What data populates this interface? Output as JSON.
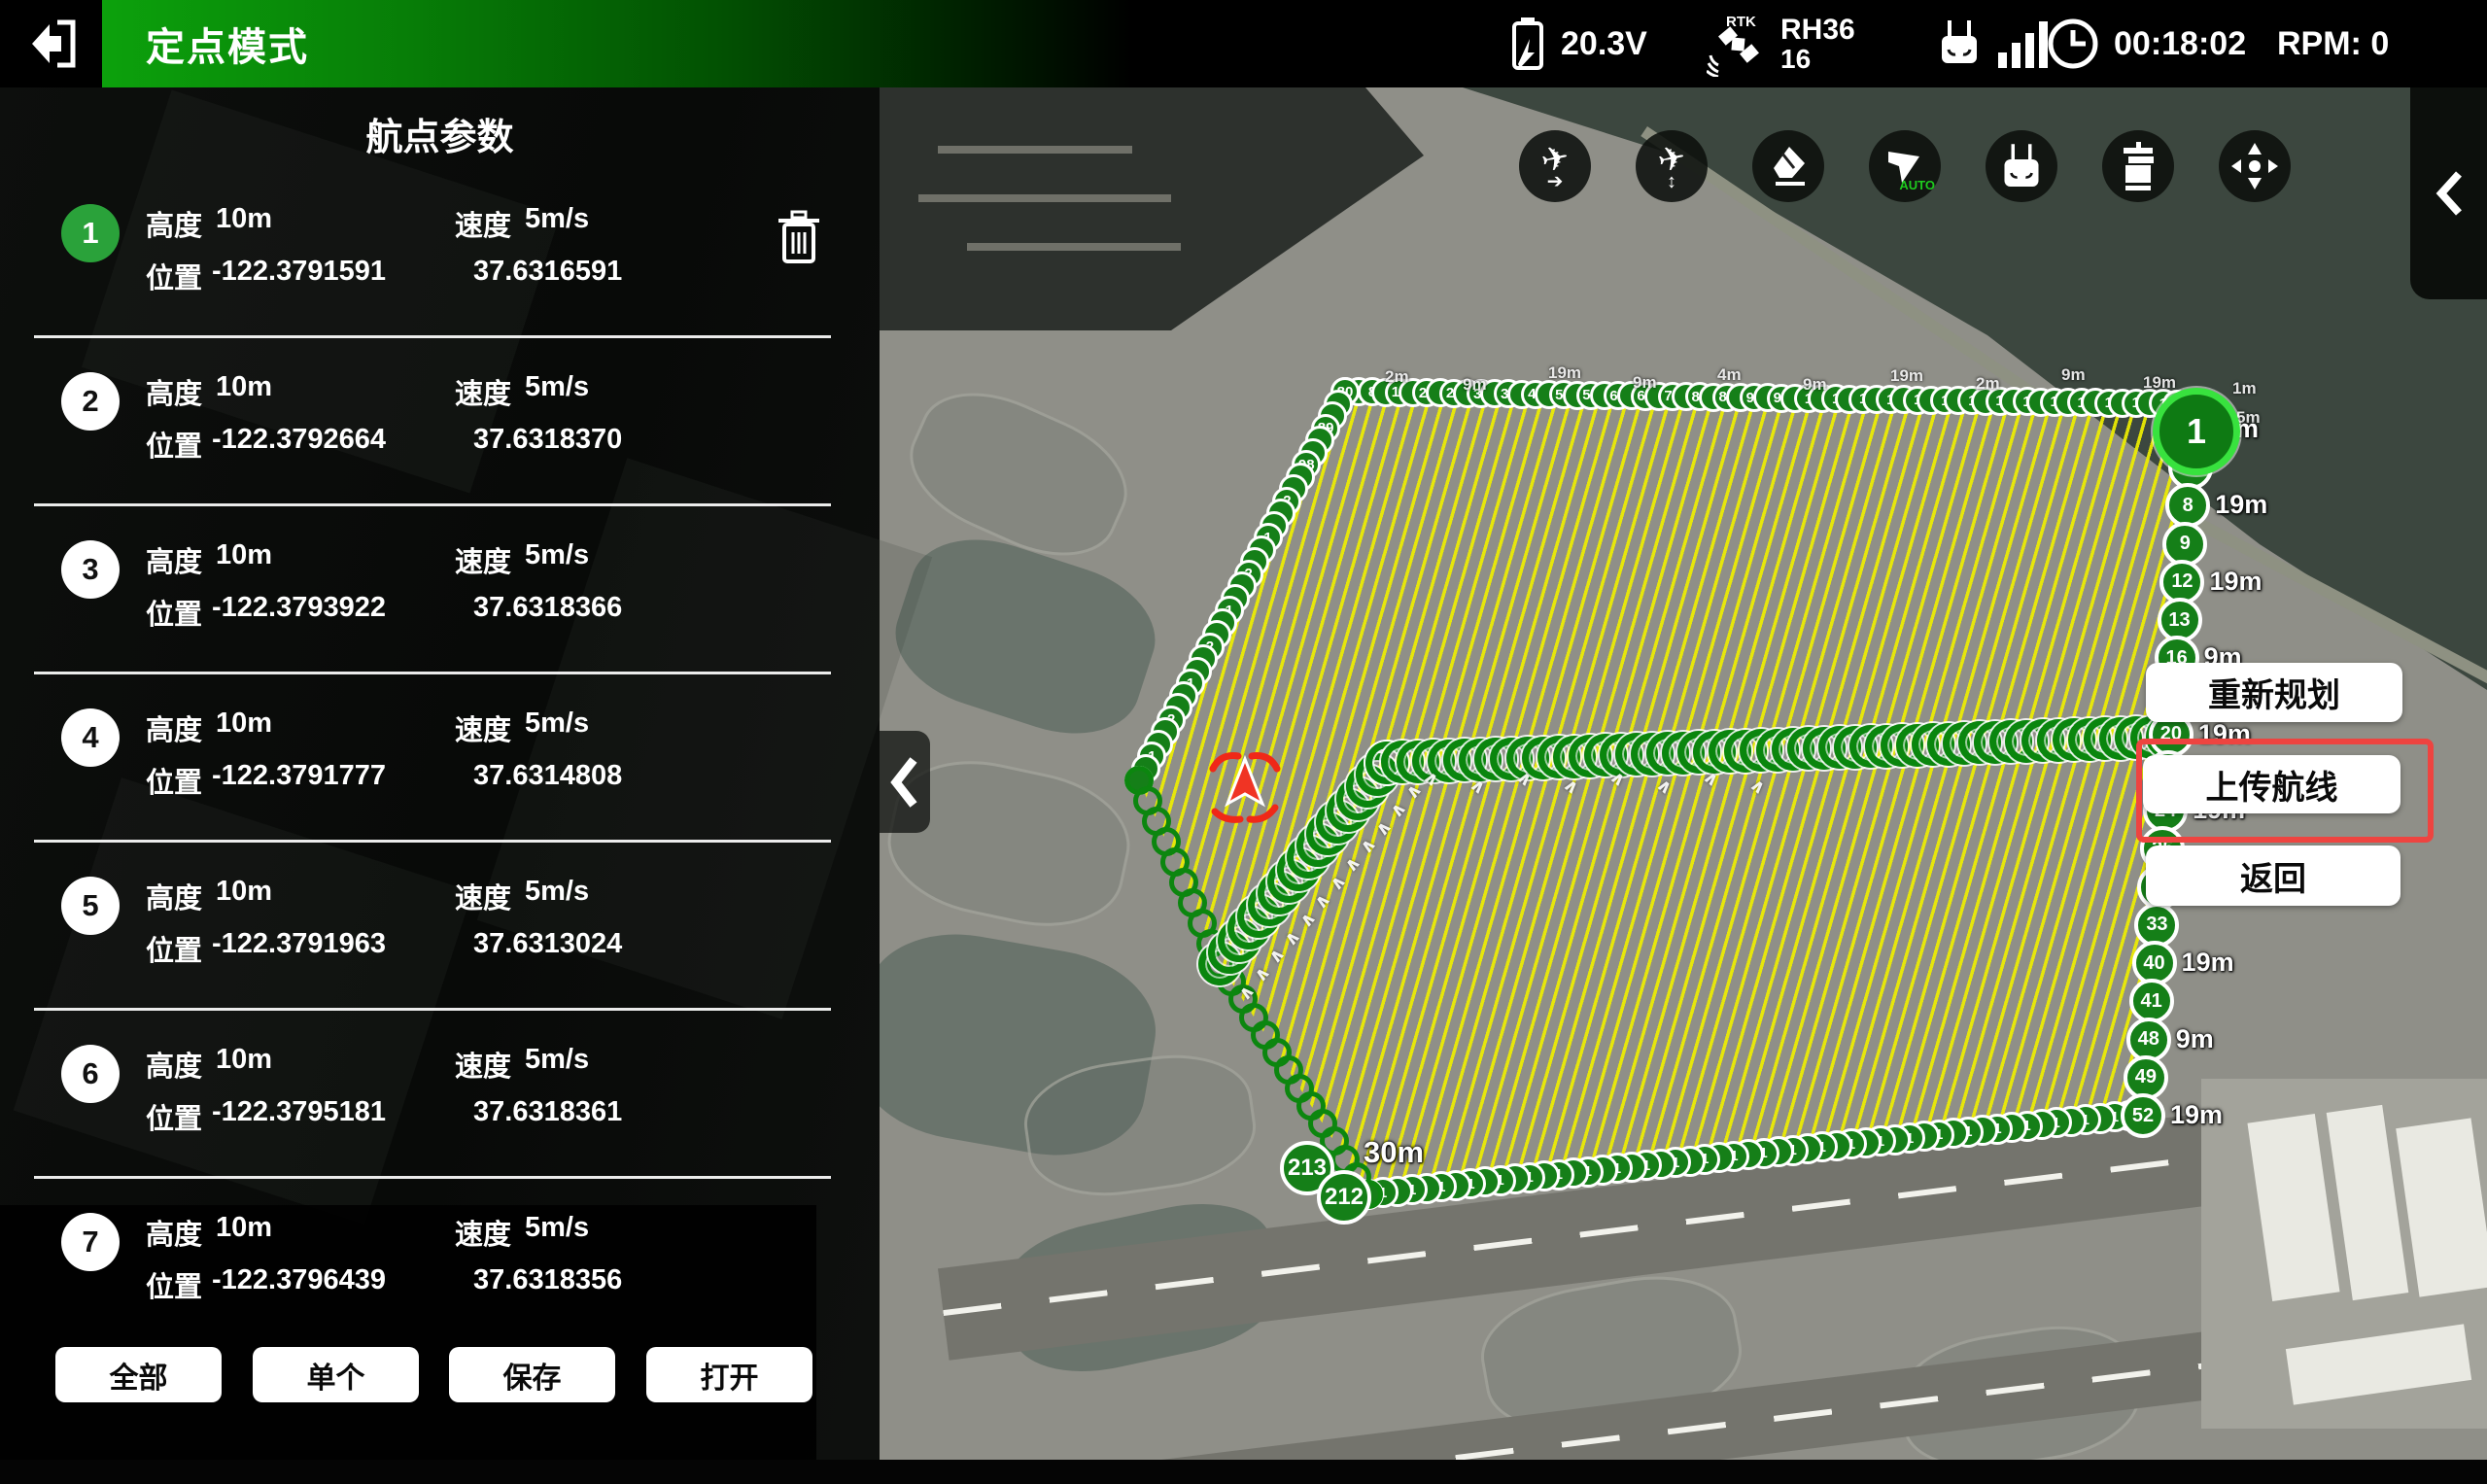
{
  "header": {
    "mode": "定点模式",
    "voltage": "20.3V",
    "rtk_name": "RH36",
    "rtk_count": "16",
    "time": "00:18:02",
    "rpm": "RPM: 0"
  },
  "toolbar": {
    "auto_label": "AUTO",
    "icons": [
      "plane-forward-icon",
      "plane-altitude-icon",
      "eraser-icon",
      "auto-route-icon",
      "remote-controller-icon",
      "gimbal-icon",
      "dpad-icon"
    ]
  },
  "sidebar": {
    "title": "航点参数",
    "labels": {
      "altitude": "高度",
      "speed": "速度",
      "position": "位置"
    },
    "waypoints": [
      {
        "n": "1",
        "alt": "10m",
        "speed": "5m/s",
        "lon": "-122.3791591",
        "lat": "37.6316591",
        "selected": true
      },
      {
        "n": "2",
        "alt": "10m",
        "speed": "5m/s",
        "lon": "-122.3792664",
        "lat": "37.6318370",
        "selected": false
      },
      {
        "n": "3",
        "alt": "10m",
        "speed": "5m/s",
        "lon": "-122.3793922",
        "lat": "37.6318366",
        "selected": false
      },
      {
        "n": "4",
        "alt": "10m",
        "speed": "5m/s",
        "lon": "-122.3791777",
        "lat": "37.6314808",
        "selected": false
      },
      {
        "n": "5",
        "alt": "10m",
        "speed": "5m/s",
        "lon": "-122.3791963",
        "lat": "37.6313024",
        "selected": false
      },
      {
        "n": "6",
        "alt": "10m",
        "speed": "5m/s",
        "lon": "-122.3795181",
        "lat": "37.6318361",
        "selected": false
      },
      {
        "n": "7",
        "alt": "10m",
        "speed": "5m/s",
        "lon": "-122.3796439",
        "lat": "37.6318356",
        "selected": false
      }
    ],
    "buttons": {
      "all": "全部",
      "single": "单个",
      "save": "保存",
      "open": "打开"
    }
  },
  "map": {
    "action_buttons": {
      "replan": "重新规划",
      "upload": "上传航线",
      "back": "返回"
    },
    "wp1_label": "1",
    "corner_markers": [
      {
        "n": "213",
        "alt": "30m"
      },
      {
        "n": "212",
        "alt": ""
      }
    ],
    "right_edge_markers": [
      {
        "n": "4",
        "alt": "4m"
      },
      {
        "n": "5",
        "alt": ""
      },
      {
        "n": "8",
        "alt": "19m"
      },
      {
        "n": "9",
        "alt": ""
      },
      {
        "n": "12",
        "alt": "19m"
      },
      {
        "n": "13",
        "alt": ""
      },
      {
        "n": "16",
        "alt": "9m"
      },
      {
        "n": "17",
        "alt": ""
      },
      {
        "n": "20",
        "alt": "19m"
      },
      {
        "n": "21",
        "alt": ""
      },
      {
        "n": "24",
        "alt": "19m"
      },
      {
        "n": "25",
        "alt": ""
      },
      {
        "n": "32",
        "alt": "9m"
      },
      {
        "n": "33",
        "alt": ""
      },
      {
        "n": "40",
        "alt": "19m"
      },
      {
        "n": "41",
        "alt": ""
      },
      {
        "n": "48",
        "alt": "9m"
      },
      {
        "n": "49",
        "alt": ""
      },
      {
        "n": "52",
        "alt": "19m"
      }
    ],
    "fuzz_labels": [
      "2m",
      "9m",
      "19m",
      "9m",
      "4m",
      "9m",
      "19m",
      "2m",
      "9m",
      "19m",
      "1m",
      "5m"
    ],
    "texture_digits": [
      "1",
      "2"
    ],
    "colors": {
      "hatch_yellow": "#eeee00",
      "route_green": "#0a860e",
      "marker_green": "#157f18",
      "selected_green": "#2aa23a",
      "annotation_red": "#ee4440"
    }
  }
}
